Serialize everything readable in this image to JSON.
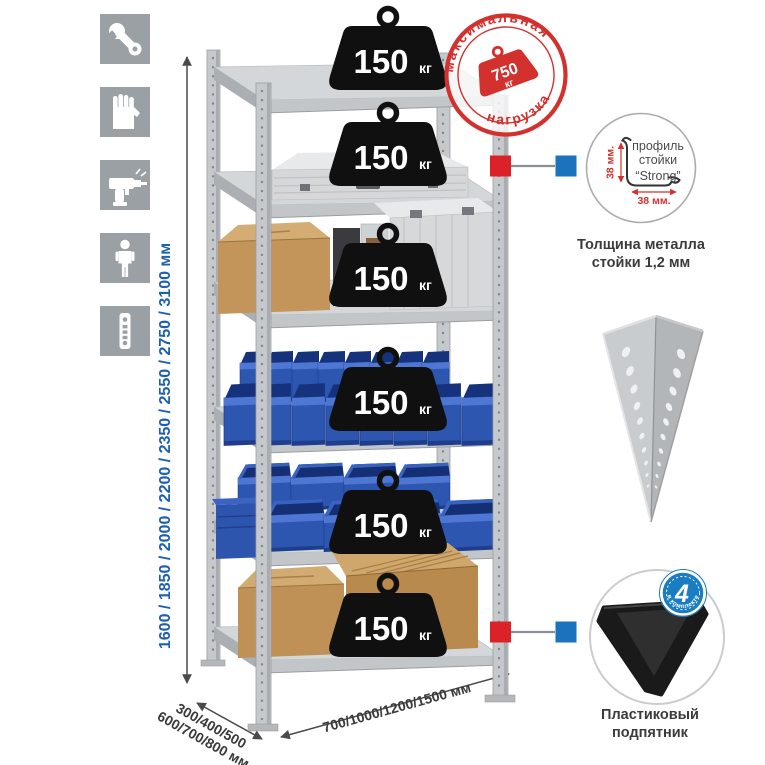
{
  "colors": {
    "stamp_red": "#d2312d",
    "dimension_blue": "#1e5fae",
    "label_dark": "#3a3a3a",
    "connector_red": "#da2228",
    "connector_blue": "#1a73bc",
    "bin_blue": "#2c56b0",
    "badge_blue": "#1a7cc1",
    "icon_gray": "#9ba0a5"
  },
  "left_icons": [
    {
      "name": "wrench-icon"
    },
    {
      "name": "gloves-icon"
    },
    {
      "name": "drill-icon"
    },
    {
      "name": "person-icon"
    },
    {
      "name": "post-profile-icon"
    }
  ],
  "dimensions": {
    "height": "1600 / 1850 / 2000 / 2200 / 2350 / 2550 / 2750 / 3100 мм",
    "depth_line1": "300/400/500",
    "depth_line2": "600/700/800 мм",
    "width": "700/1000/1200/1500 мм"
  },
  "shelf_weight": {
    "value": "150",
    "unit": "кг",
    "shelves_count": 6
  },
  "stamp": {
    "arc_top": "максимальная",
    "arc_bottom": "нагрузка",
    "value": "750",
    "unit": "кг"
  },
  "profile_detail": {
    "line1": "профиль",
    "line2": "стойки",
    "line3": "“Strong”",
    "dim_vertical": "38 мм.",
    "dim_horizontal": "38 мм.",
    "caption_line1": "Толщина металла",
    "caption_line2": "стойки 1,2 мм"
  },
  "foot_detail": {
    "badge_number": "4",
    "badge_arc_text": "в комплекте",
    "caption_line1": "Пластиковый",
    "caption_line2": "подпятник"
  }
}
